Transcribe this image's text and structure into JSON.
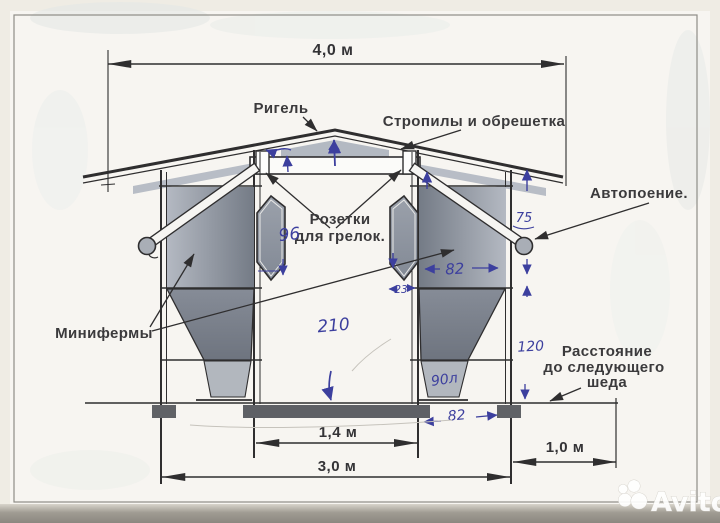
{
  "labels": {
    "rigel": "Ригель",
    "rafters": "Стропилы и обрешетка",
    "auto_watering": "Автопоение.",
    "sockets_line1": "Розетки",
    "sockets_line2": "для грелок.",
    "minifarms": "Минифермы",
    "distance_line1": "Расстояние",
    "distance_line2": "до следующего",
    "distance_line3": "шеда"
  },
  "dimensions": {
    "roof_span": "4,0 м",
    "aisle_width": "1,4 м",
    "frame_width": "3,0 м",
    "shed_gap": "1,0 м"
  },
  "handwritten": {
    "socket_mark": "96",
    "pipe_mark": "75",
    "cage_width": "82",
    "window_depth": "23",
    "aisle_height": "210",
    "hopper_volume": "90л",
    "clearance": "120",
    "base_width": "82"
  },
  "watermark": {
    "brand": "Avito"
  },
  "colors": {
    "ink": "#2f2e2f",
    "pen_blue": "#3c3f9e",
    "paper": "#f7f5f1",
    "panel_gray": "#8a919c"
  }
}
